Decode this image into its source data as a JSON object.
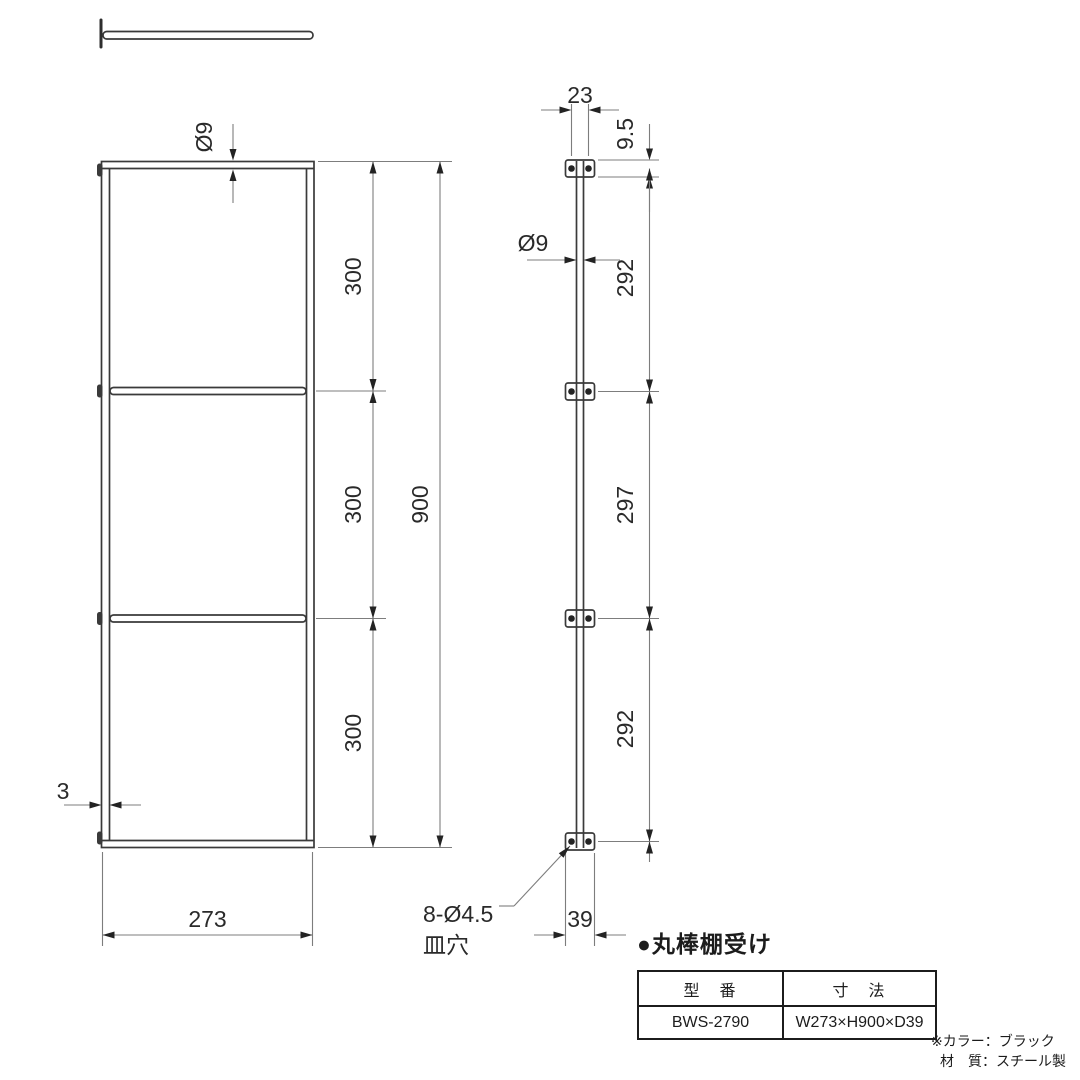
{
  "product": {
    "title": "●丸棒棚受け",
    "table": {
      "headers": [
        "型　番",
        "寸　法"
      ],
      "model": "BWS-2790",
      "dimensions": "W273×H900×D39"
    },
    "notes": [
      "※カラー：ブラック",
      "材　質：スチール製"
    ]
  },
  "front_view": {
    "diameter_label": "Ø9",
    "segment_labels": [
      "300",
      "300",
      "300"
    ],
    "overall_label": "900",
    "thickness_label": "3",
    "width_label": "273"
  },
  "side_view": {
    "plate_width_label": "23",
    "plate_height_label": "9.5",
    "rod_diameter_label": "Ø9",
    "segment_labels": [
      "292",
      "297",
      "292"
    ],
    "depth_label": "39",
    "hole_label_line1": "8-Ø4.5",
    "hole_label_line2": "皿穴"
  },
  "colors": {
    "object_line": "#3a3a3a",
    "dimension_line": "#7d7d7d",
    "text": "#2a2a2a",
    "background": "#ffffff"
  }
}
